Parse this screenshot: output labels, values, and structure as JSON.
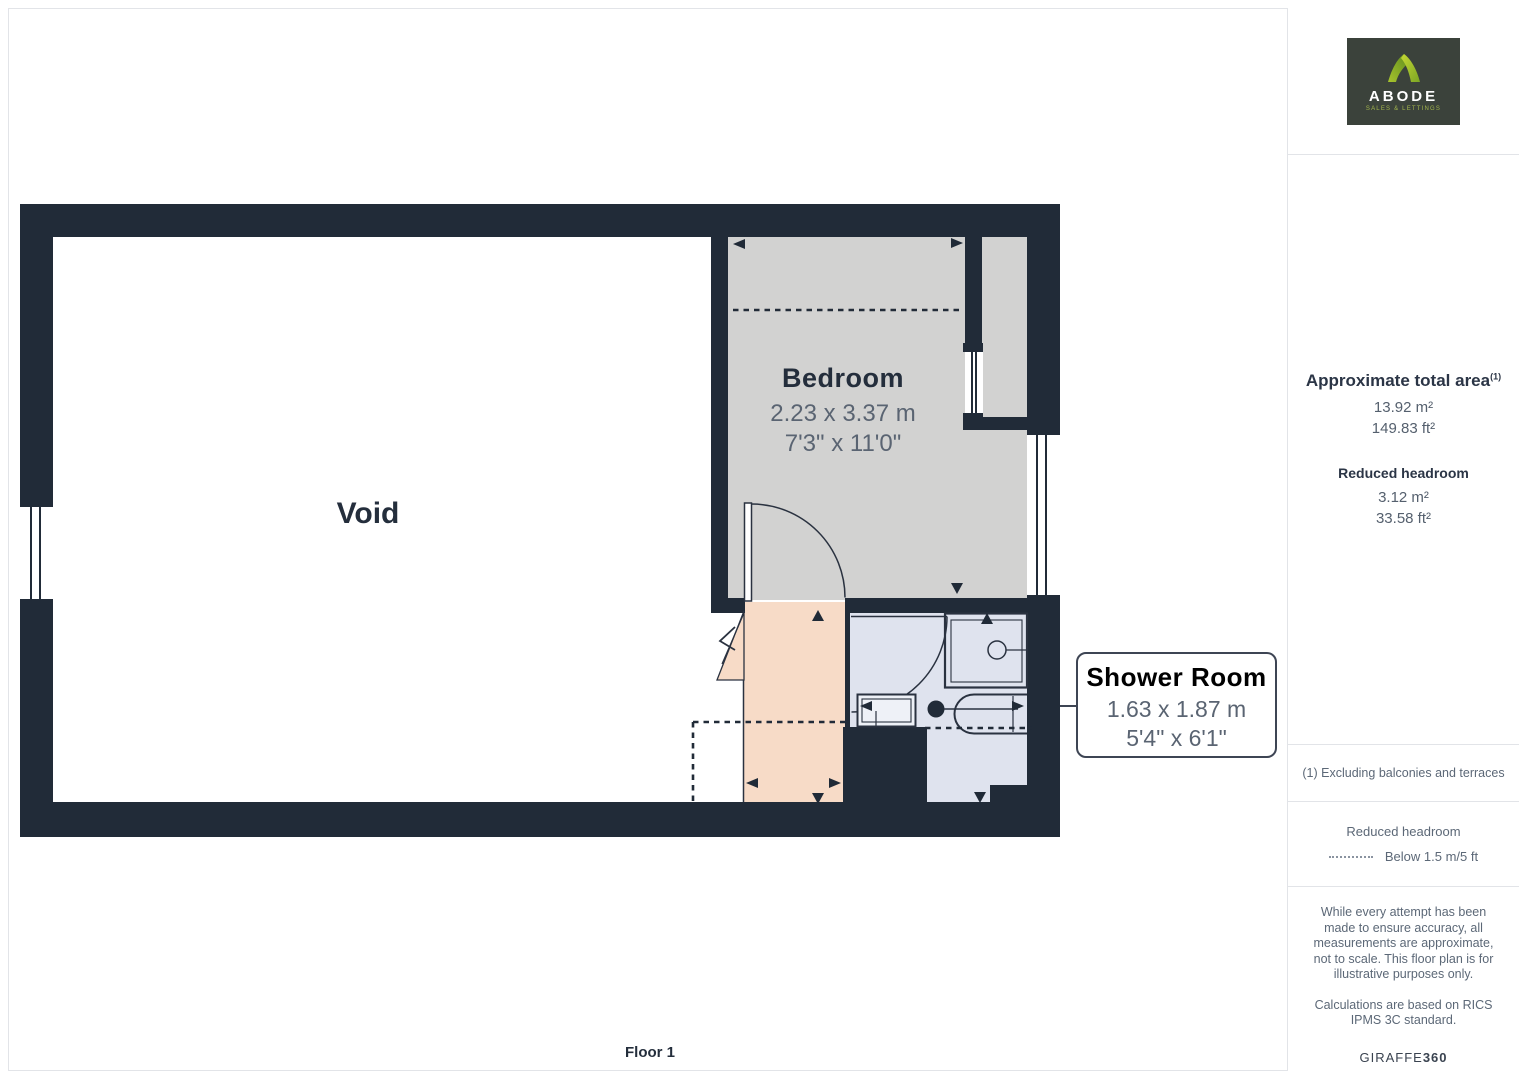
{
  "branding": {
    "logo_name": "ABODE",
    "logo_tagline": "SALES & LETTINGS",
    "footer_brand_regular": "GIRAFFE",
    "footer_brand_bold": "360"
  },
  "floor": {
    "label": "Floor 1"
  },
  "rooms": [
    {
      "name": "Void"
    },
    {
      "name": "Bedroom",
      "size_metric": "2.23 x 3.37 m",
      "size_imperial": "7'3\" x 11'0\""
    },
    {
      "name": "Shower Room",
      "size_metric": "1.63 x 1.87 m",
      "size_imperial": "5'4\" x 6'1\""
    }
  ],
  "sidebar": {
    "total_area": {
      "title": "Approximate total area",
      "footnote_marker": "(1)",
      "metric": "13.92 m²",
      "imperial": "149.83 ft²"
    },
    "reduced_headroom": {
      "title": "Reduced headroom",
      "metric": "3.12 m²",
      "imperial": "33.58 ft²"
    },
    "footnote": "(1) Excluding balconies and terraces",
    "legend": {
      "title": "Reduced headroom",
      "item": "Below 1.5 m/5 ft"
    },
    "disclaimer1": "While every attempt has been made to ensure accuracy, all measurements are approximate, not to scale. This floor plan is for illustrative purposes only.",
    "disclaimer2": "Calculations are based on RICS IPMS 3C standard."
  },
  "colors": {
    "wall": "#212b38",
    "bedroom_fill": "#d2d2d1",
    "landing_fill": "#f7dbc7",
    "shower_fill": "#dfe3ee",
    "logo_background": "#3b423b",
    "logo_green": "#8fb621",
    "text_muted": "#5c6877"
  }
}
